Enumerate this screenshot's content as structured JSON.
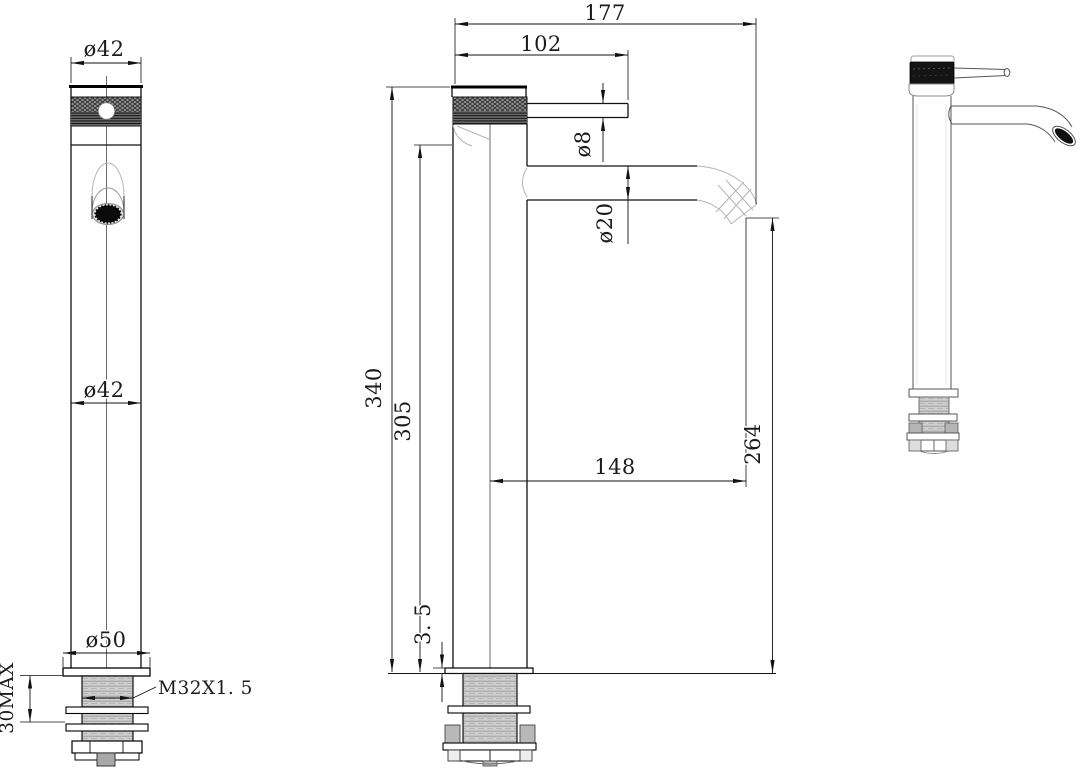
{
  "drawing": {
    "dims": {
      "front_knob_diameter": "ø42",
      "front_body_diameter": "ø42",
      "front_base_diameter": "ø50",
      "thread_spec": "M32X1. 5",
      "counter_thickness_max": "30MAX",
      "overall_reach": "177",
      "handle_length": "102",
      "handle_diameter": "ø8",
      "spout_diameter": "ø20",
      "overall_height": "340",
      "height_to_spout_base": "305",
      "spout_reach_from_center": "148",
      "spout_outlet_height": "264",
      "deck_plate_thickness": "3. 5"
    },
    "colors": {
      "line": "#111111",
      "background": "#ffffff",
      "projection_gray": "#b5b5b5",
      "thread_fill": "#cfcfcf",
      "knurl_dark": "#141414"
    }
  }
}
